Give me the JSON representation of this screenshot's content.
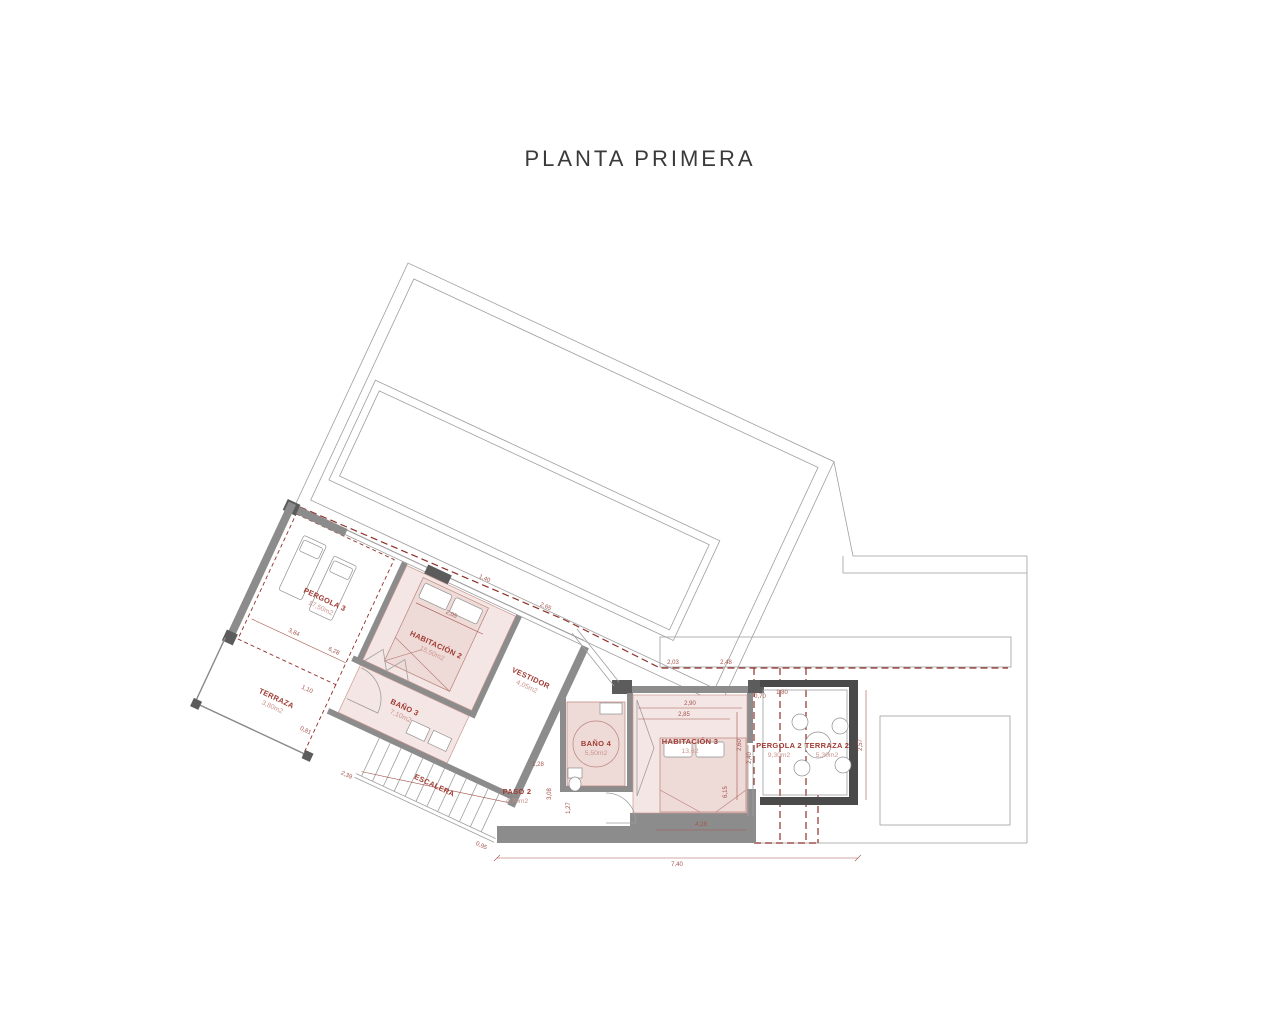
{
  "title": "PLANTA PRIMERA",
  "rooms": {
    "pergola3": {
      "name": "PERGOLA 3",
      "area": "17,50m2"
    },
    "terraza": {
      "name": "TERRAZA",
      "area": "3,80m2"
    },
    "habitacion2": {
      "name": "HABITACIÓN 2",
      "area": "15,50m2"
    },
    "bano3": {
      "name": "BAÑO 3",
      "area": "7,10m2"
    },
    "vestidor": {
      "name": "VESTIDOR",
      "area": "4,05m2"
    },
    "escalera": {
      "name": "ESCALERA"
    },
    "paso2": {
      "name": "PASO 2",
      "area": "4,70m2"
    },
    "bano4": {
      "name": "BAÑO 4",
      "area": "5,50m2"
    },
    "habitacion3": {
      "name": "HABITACIÓN 3",
      "area": "13,62"
    },
    "pergola2": {
      "name": "PERGOLA 2",
      "area": "9,30m2"
    },
    "terraza2": {
      "name": "TERRAZA 2",
      "area": "5,30m2"
    }
  },
  "dims": [
    "7,40",
    "4,28",
    "2,90",
    "2,85",
    "2,60",
    "6,15",
    "2,03",
    "2,48",
    "0,70",
    "1,80",
    "2,40",
    "2,57",
    "1,27",
    "3,08",
    "1,28",
    "3,84",
    "6,28",
    "2,05",
    "1,40",
    "2,65",
    "2,39",
    "0,95",
    "1,10",
    "0,81"
  ],
  "colors": {
    "wall": "#8c8c8c",
    "wall_dark": "#4a4a4a",
    "outline": "#9f9f9f",
    "boundary_red": "#8e2f28",
    "label_red": "#a03b33",
    "area_red": "#cc958e",
    "room_pink": "#f4e6e4"
  }
}
